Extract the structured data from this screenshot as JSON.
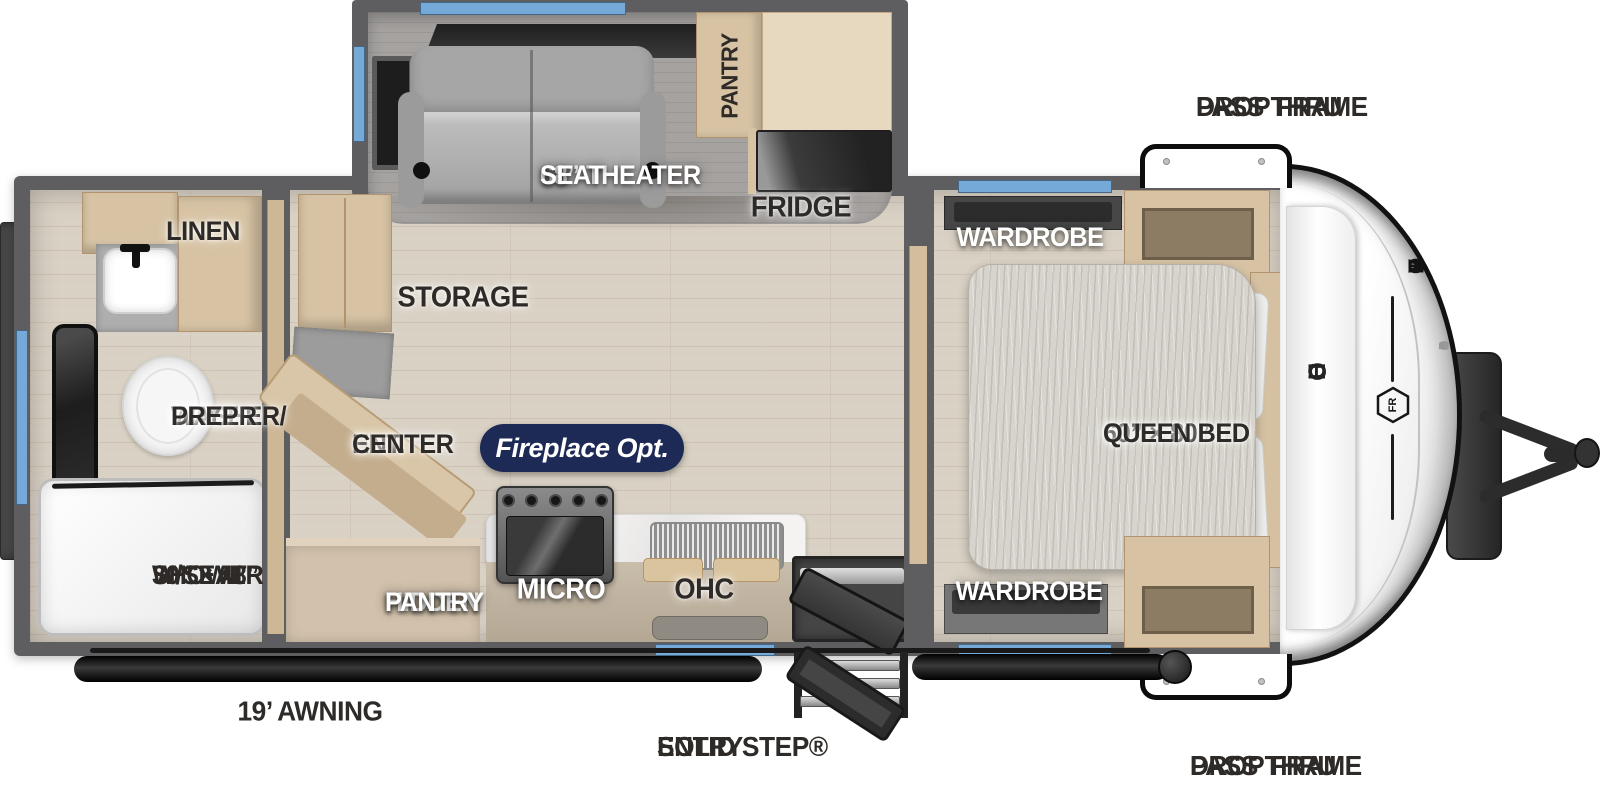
{
  "title": "Solaire Travel Trailer Floorplan",
  "colors": {
    "accent_blue": "#74a9d8",
    "wall_gray": "#5e5e60",
    "floor_tan": "#d9d1c4",
    "cabinet_tan": "#d7c3a4",
    "badge_navy": "#1d2a56",
    "seat_gray": "#b3b3b3"
  },
  "exterior": {
    "drop_frame_top": [
      "DROP FRAME",
      "PASS THRU"
    ],
    "drop_frame_bottom": [
      "DROP FRAME",
      "PASS THRU"
    ],
    "awning": "19’ AWNING",
    "solid_step": [
      "SOLID STEP®",
      "ENTRY"
    ]
  },
  "slideout": {
    "theater_seat": [
      "68” THEATER",
      "SEAT"
    ],
    "pantry": "PANTRY",
    "fridge": "FRIDGE"
  },
  "living": {
    "storage": "STORAGE",
    "ent_center": [
      "ENT.",
      "CENTER"
    ],
    "fireplace_badge": "Fireplace Opt.",
    "hidden_pantry": [
      "HIDDEN",
      "PANTRY"
    ],
    "micro": "MICRO",
    "ohc": "OHC"
  },
  "bathroom": {
    "linen": "LINEN",
    "washer_dryer": [
      "WASHER/",
      "DRYER",
      "PREP"
    ],
    "shower": [
      "30” × 48”",
      "SHOWER",
      "W/SEAT"
    ]
  },
  "bedroom": {
    "wardrobe_top": "WARDROBE",
    "wardrobe_bottom": "WARDROBE",
    "queen_bed": [
      "60” × 80”",
      "QUEEN BED"
    ],
    "ohc": "OHC"
  },
  "brand": {
    "name": "FOREST RIVER",
    "model": "SOLAIRE",
    "logo": "FR"
  }
}
